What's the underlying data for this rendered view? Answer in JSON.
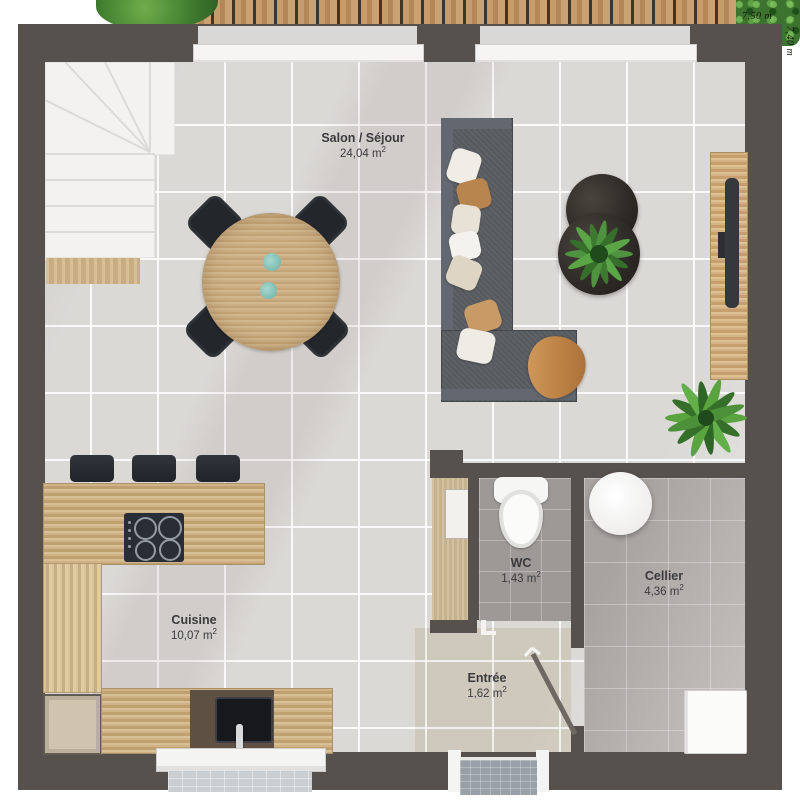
{
  "plan": {
    "type": "floor-plan",
    "dimensions": {
      "width_label": "7,50 m",
      "height_label": "7,40 m"
    },
    "rooms": [
      {
        "name": "Salon / Séjour",
        "area": "24,04 m",
        "sup": "2"
      },
      {
        "name": "Cuisine",
        "area": "10,07 m",
        "sup": "2"
      },
      {
        "name": "WC",
        "area": "1,43 m",
        "sup": "2"
      },
      {
        "name": "Cellier",
        "area": "4,36 m",
        "sup": "2"
      },
      {
        "name": "Entrée",
        "area": "1,62 m",
        "sup": "2"
      }
    ],
    "colors": {
      "wall": "#57514e",
      "main_tile": "#dbd9d6",
      "entree_tile": "#cfc8bc",
      "wc_tile": "#9c9996",
      "cellier_tile": "#a7a3a0",
      "wood": "#c8a478",
      "deck_wood": "#c69c6b",
      "sofa": "#565a5f",
      "plant_green": "#4f9240",
      "accent_teal": "#8ec7bd",
      "blanket_orange": "#c78a4e"
    }
  }
}
